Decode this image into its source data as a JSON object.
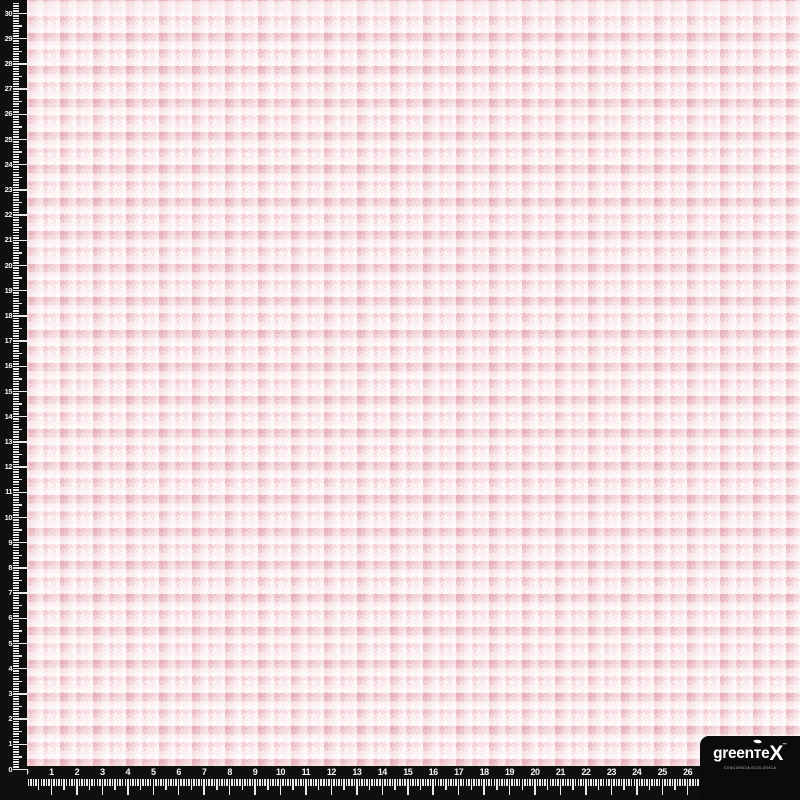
{
  "fabric": {
    "description": "pink houndstooth check fabric swatch",
    "pattern": "houndstooth-plaid"
  },
  "colors": {
    "ruler_bg": "#0f0f0f",
    "tick": "#e9e9e9",
    "label": "#f5f5f5",
    "fabric_base": "#fdf3f4",
    "motif_pink": "#f1c9d1",
    "band_pink": "rgba(214,128,144,0.20)",
    "white_row": "rgba(255,255,255,0.55)",
    "white_col": "rgba(255,255,255,0.35)",
    "logo_box": "#0b0b0b"
  },
  "rulers": {
    "vertical": {
      "labels": [
        "0",
        "1",
        "2",
        "3",
        "4",
        "5",
        "6",
        "7",
        "8",
        "9",
        "10",
        "11",
        "12",
        "13",
        "14",
        "15",
        "16",
        "17",
        "18",
        "19",
        "20",
        "21",
        "22",
        "23",
        "24",
        "25",
        "26",
        "27",
        "28",
        "29",
        "30"
      ],
      "origin_y": 769.5,
      "px_per_unit": 25.2,
      "subdivisions": 10
    },
    "horizontal": {
      "labels": [
        "0",
        "1",
        "2",
        "3",
        "4",
        "5",
        "6",
        "7",
        "8",
        "9",
        "10",
        "11",
        "12",
        "13",
        "14",
        "15",
        "16",
        "17",
        "18",
        "19",
        "20",
        "21",
        "22",
        "23",
        "24",
        "25",
        "26",
        "27",
        "28",
        "29",
        "30"
      ],
      "origin_x": 26,
      "px_per_unit": 25.45,
      "subdivisions": 10
    }
  },
  "logo": {
    "brand_head": "greenте",
    "brand_tail": "X",
    "mark": "™",
    "tagline": "conciencia ecológica"
  }
}
